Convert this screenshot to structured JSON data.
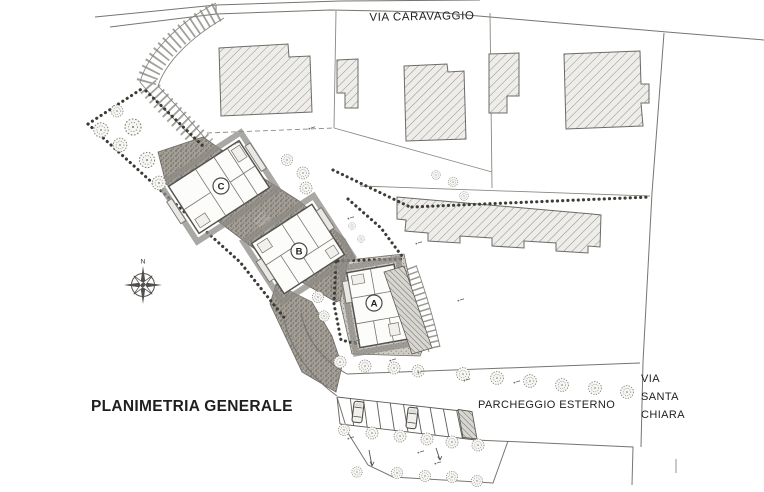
{
  "plan": {
    "drawing_title": "PLANIMETRIA GENERALE",
    "roads": {
      "top": "VIA CARAVAGGIO",
      "right_line1": "VIA",
      "right_line2": "SANTA",
      "right_line3": "CHIARA"
    },
    "parking_label": "PARCHEGGIO ESTERNO",
    "compass": {
      "north": "N"
    },
    "new_buildings": [
      {
        "label": "A"
      },
      {
        "label": "B"
      },
      {
        "label": "C"
      }
    ]
  },
  "colors": {
    "paper": "#ffffff",
    "line": "#77756f",
    "hatch_fill": "#eeedea",
    "hatch_line": "#90908c",
    "driveway": "#a39f97",
    "text": "#1f1f1f"
  }
}
